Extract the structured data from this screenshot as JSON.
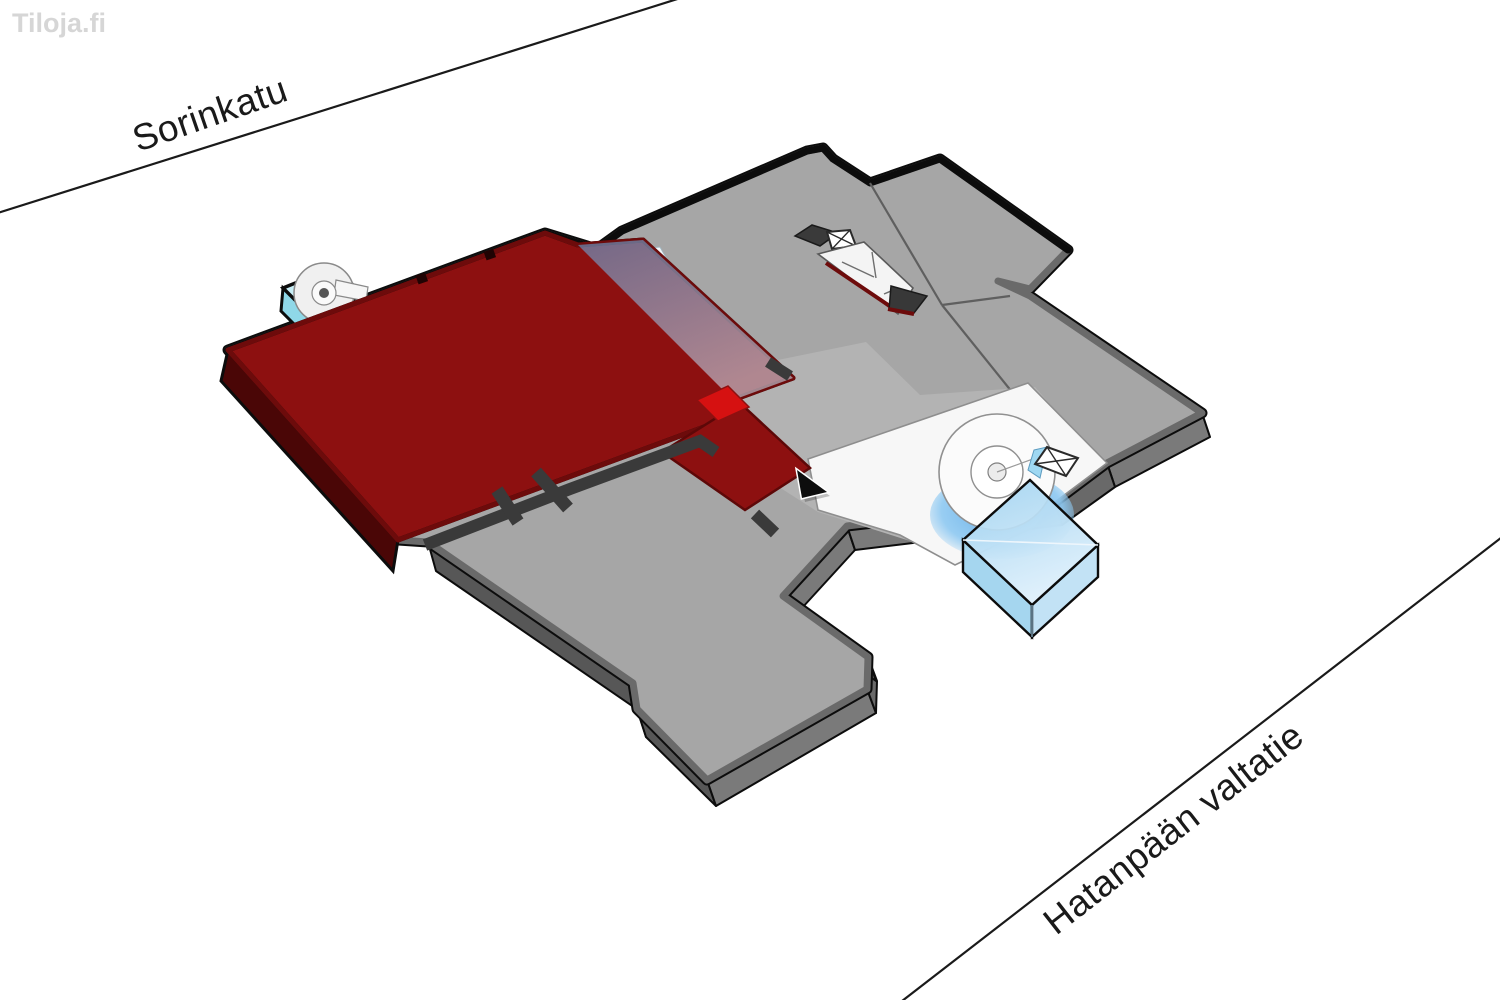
{
  "app": {
    "watermark": "Tiloja.fi"
  },
  "streets": {
    "top": {
      "label": "Sorinkatu"
    },
    "bottom": {
      "label": "Hatanpään valtatie"
    }
  },
  "floorplan": {
    "type": "isometric-floorplan",
    "selected_room_color": "#8d1010",
    "floor_color": "#a6a6a6",
    "glass_color": "#5fb0e8",
    "features": [
      "selected-room",
      "skylight-strip",
      "corridor",
      "spiral-stair-left",
      "circular-stair-right",
      "elevator-core-top",
      "elevator-core-right",
      "glass-entrance-box",
      "lower-floor-slab"
    ]
  },
  "colors": {
    "floor": "#a6a6a6",
    "floor-light": "#b3b3b3",
    "wall": "#6a6a6a",
    "side": "#575757",
    "side-light": "#7a7a7a",
    "side-mid": "#696969",
    "shaft": "#3a3a3a",
    "room-red": "#8d1010",
    "room-red-bright": "#d61111",
    "room-red-side": "#4a0606",
    "room-red-band": "#6d0b0b",
    "glass-blue-top": "#5fb0e8",
    "glass-blue-bottom": "#cde9fa",
    "glass-cyan": "#c8eef6",
    "glass-cyan-side": "#8fd8e8",
    "glass-cyan-side2": "#a8e2ef",
    "white-floor": "#f7f7f7",
    "ink": "#1a1a1a",
    "watermark": "#d6d6d6"
  }
}
